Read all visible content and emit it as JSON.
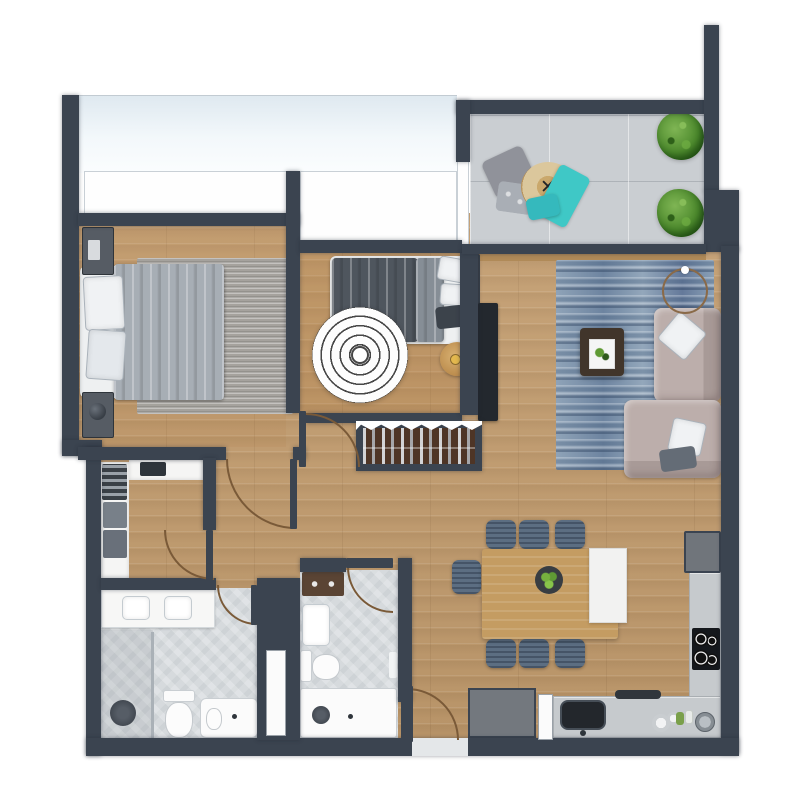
{
  "meta": {
    "kind": "apartment-floor-plan-render",
    "view": "top-down"
  },
  "palette": {
    "wall": "#3b4450",
    "wood": "#c29c6e",
    "tile_balcony": "#caced2",
    "tile_bath": "#d6dadd",
    "rug_blue": "#7d92aa",
    "rug_gray": "#a5a29d",
    "sofa": "#b3a5a2",
    "counter": "#c6cacd",
    "chair": "#5c6e82",
    "table_wood": "#c49c62",
    "coffee": "#41352b",
    "duvet_light": "#a7aeb5",
    "duvet_dark": "#4f565e",
    "furniture_dark": "#565c64",
    "teal": "#3fc8c6",
    "door_arc": "#7a5a38",
    "sill": "#b08a58",
    "plant_green": "#4d8a2d",
    "accent_white": "#ffffff"
  },
  "icons": {
    "pouf_x": "✕"
  },
  "rooms": [
    {
      "id": "master-bedroom",
      "furniture": [
        "double-bed",
        "gray-rug",
        "nightstand-top",
        "nightstand-bottom",
        "table-lamp"
      ]
    },
    {
      "id": "bedroom-2",
      "furniture": [
        "double-bed",
        "round-maze-rug",
        "wood-stool",
        "wardrobe-wall",
        "shoe-rack"
      ]
    },
    {
      "id": "walk-in-closet",
      "furniture": [
        "shelving-left",
        "shelving-top",
        "storage-boxes",
        "hanging-clothes"
      ]
    },
    {
      "id": "bathroom-1",
      "furniture": [
        "double-sink-vanity",
        "shower",
        "toilet",
        "bathtub"
      ]
    },
    {
      "id": "bathroom-2",
      "furniture": [
        "sink",
        "toilet",
        "shower-tray",
        "wood-cabinet"
      ]
    },
    {
      "id": "living-room",
      "furniture": [
        "blue-rug",
        "l-shaped-sofa",
        "coffee-table",
        "tv-console",
        "round-wall-decor"
      ]
    },
    {
      "id": "dining-area",
      "furniture": [
        "dining-table",
        "white-bench",
        "seven-chairs",
        "plant-centerpiece"
      ]
    },
    {
      "id": "kitchen",
      "furniture": [
        "l-counter",
        "fridge",
        "cooktop",
        "sink",
        "dishes"
      ]
    },
    {
      "id": "balcony",
      "furniture": [
        "floor-cushions",
        "woven-pouf",
        "teal-throw",
        "plant-pot-1",
        "plant-pot-2"
      ]
    },
    {
      "id": "entrance",
      "furniture": [
        "entry-door",
        "gray-cabinet",
        "door-mat"
      ]
    }
  ]
}
